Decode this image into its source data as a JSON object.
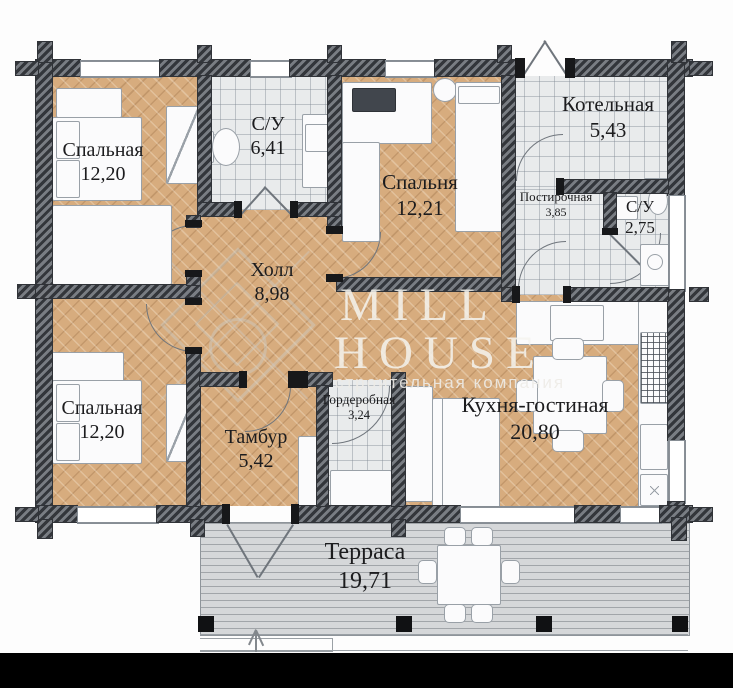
{
  "watermark": {
    "line1": "MILL",
    "line2": "HOUSE",
    "subtitle": "строительная компания"
  },
  "rooms": {
    "bedroom_top_left": {
      "name": "Спальная",
      "area": "12,20"
    },
    "bathroom_main": {
      "name": "С/У",
      "area": "6,41"
    },
    "bedroom_top_center": {
      "name": "Спальня",
      "area": "12,21"
    },
    "boiler_room": {
      "name": "Котельная",
      "area": "5,43"
    },
    "laundry": {
      "name": "Постирочная",
      "area": "3,85"
    },
    "bathroom_small": {
      "name": "С/У",
      "area": "2,75"
    },
    "hall": {
      "name": "Холл",
      "area": "8,98"
    },
    "bedroom_bottom_left": {
      "name": "Спальная",
      "area": "12,20"
    },
    "vestibule": {
      "name": "Тамбур",
      "area": "5,42"
    },
    "wardrobe_room": {
      "name": "Гордеробная",
      "area": "3,24"
    },
    "kitchen_living": {
      "name": "Кухня-гостиная",
      "area": "20,80"
    },
    "terrace": {
      "name": "Терраса",
      "area": "19,71"
    }
  },
  "colors": {
    "parquet": "#d7ac7e",
    "tile": "#e9ebec",
    "wall": "#5f646b",
    "deck": "#d5d7d9",
    "label_text": "#1c1c1e"
  }
}
